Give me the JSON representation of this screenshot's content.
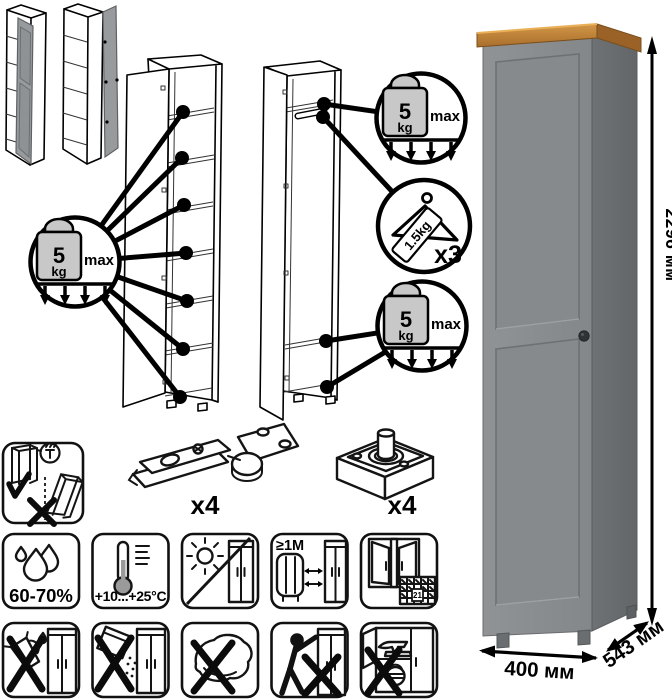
{
  "dimensions": {
    "height": "2296 мм",
    "width": "400 мм",
    "depth": "543 мм"
  },
  "load": {
    "shelf": {
      "value": "5",
      "unit": "kg",
      "qualifier": "max"
    },
    "rail": {
      "weight": "1.5kg",
      "count": "x3"
    }
  },
  "hardware": {
    "hinge_count": "x4",
    "foot_count": "x4"
  },
  "care": {
    "humidity": "60-70%",
    "temperature": "+10...+25°C",
    "heater_distance": "≥1М",
    "calendar_day": "21"
  },
  "colors": {
    "wood_top": "#c0853e",
    "door_gray": "#8c8f91",
    "side_gray": "#6d7072",
    "weight_gray": "#c8c8c8"
  }
}
